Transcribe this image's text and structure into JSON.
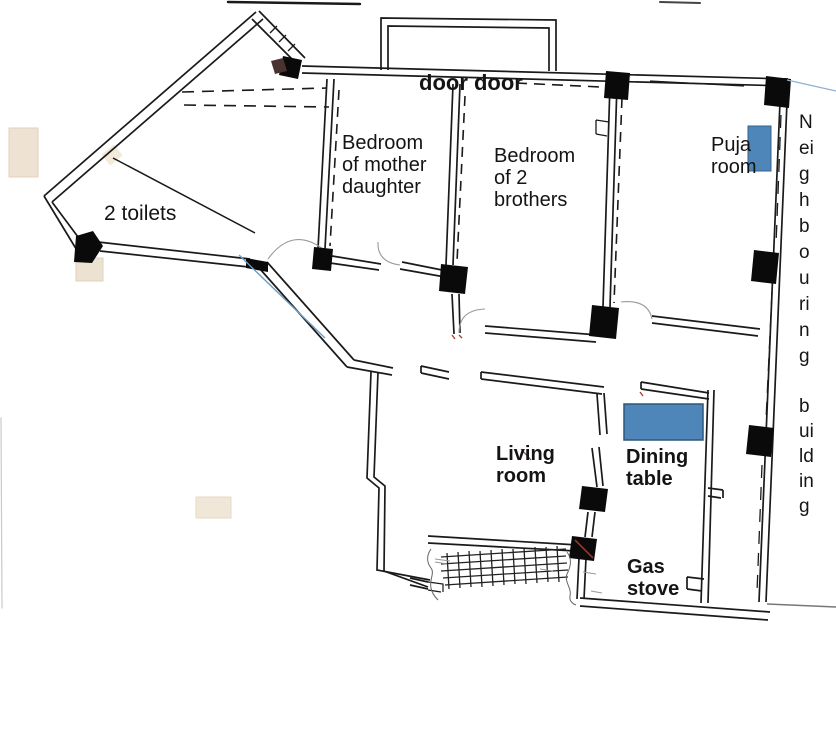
{
  "diagram": {
    "type": "hand-drawn floor plan (scanned)",
    "background_color": "#ffffff",
    "wall_color": "#1a1a1a",
    "furniture_color": "#4f86b9",
    "pen_annotation_color": "#6f9cc0",
    "labels": {
      "door_door": "door door",
      "toilets": "2 toilets",
      "bedroom_mother": [
        "Bedroom",
        "of mother",
        "daughter"
      ],
      "bedroom_brothers": [
        "Bedroom",
        "of 2",
        "brothers"
      ],
      "puja_room": [
        "Puja",
        "room"
      ],
      "living_room": [
        "Living",
        "room"
      ],
      "dining_table": [
        "Dining",
        "table"
      ],
      "gas_stove": [
        "Gas",
        "stove"
      ],
      "neighbouring_vertical": [
        "N",
        "ei",
        "g",
        "h",
        "b",
        "o",
        "u",
        "ri",
        "n",
        "g"
      ],
      "building_vertical": [
        "b",
        "ui",
        "ld",
        "in",
        "g"
      ]
    },
    "furniture": [
      {
        "name": "puja shrine",
        "color": "#4f86b9"
      },
      {
        "name": "dining table",
        "color": "#4f86b9"
      }
    ]
  }
}
